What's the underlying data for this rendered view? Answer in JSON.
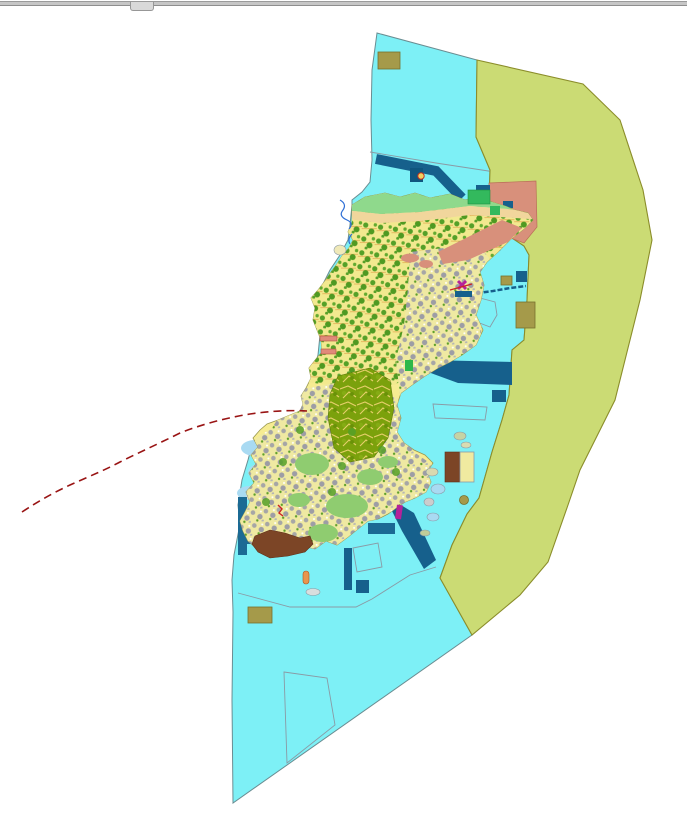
{
  "window": {
    "top_bar": {
      "kind": "collapsed-toolbar-divider",
      "handle": "drag-handle"
    }
  },
  "map": {
    "type": "gis-land-use-zoning-map",
    "palette": {
      "background": "#ffffff",
      "sea": "#7df0f6",
      "sea_border": "#6a8d92",
      "offshore_zone": "#cbdb74",
      "offshore_zone_border": "#8b8d2a",
      "island_base": "#f6ec92",
      "island_border": "#99984f",
      "forest_green": "#55a028",
      "forest_dense_bg": "#7ba10c",
      "forest_vein": "#e6cf6a",
      "urban_gray": "#a6a6a6",
      "mottle_bg": "#f2e98f",
      "gray_mottle_bg": "#efe9a2",
      "salmon_zone": "#d8907b",
      "salmon_border": "#b96e57",
      "navy_structure": "#16608c",
      "teal_pier": "#1b6a94",
      "khaki_block": "#a59a4a",
      "khaki_border": "#77702c",
      "brown_patch": "#7c4526",
      "coast_green_strip": "#8fd98c",
      "beach_strip": "#f1d69c",
      "pale_blue_shallows": "#a9daf2",
      "light_green_patch": "#8fcc70",
      "bright_green_block": "#33b95d",
      "red_route": "#991414",
      "magenta_marker": "#b5229a",
      "orange_buoy": "#e8954e",
      "thin_outline": "#8a9aa5",
      "blue_pen_coastline": "#2f6fd6",
      "light_gray_flat": "#d9d9d9"
    },
    "regions": {
      "sea": "coastal-waters",
      "offshore_zone": "offshore-buffer-band",
      "island": "main-island-landuse",
      "salmon_zone": "northeast-development-zone",
      "forest": "central-forest-parcels",
      "urban": "urban-mottled-areas"
    },
    "features": [
      "north-breakwater-band",
      "ne-harbor-band",
      "se-harbor-band",
      "west-t-pier",
      "jetty-causeway-line",
      "ferry-terminal-marker",
      "khaki-facility-blocks",
      "brown-port-patch",
      "brown-yellow-facility",
      "red-dashed-route",
      "survey-outline-polygons",
      "coastline-pen-sketch",
      "offshore-islets"
    ]
  }
}
